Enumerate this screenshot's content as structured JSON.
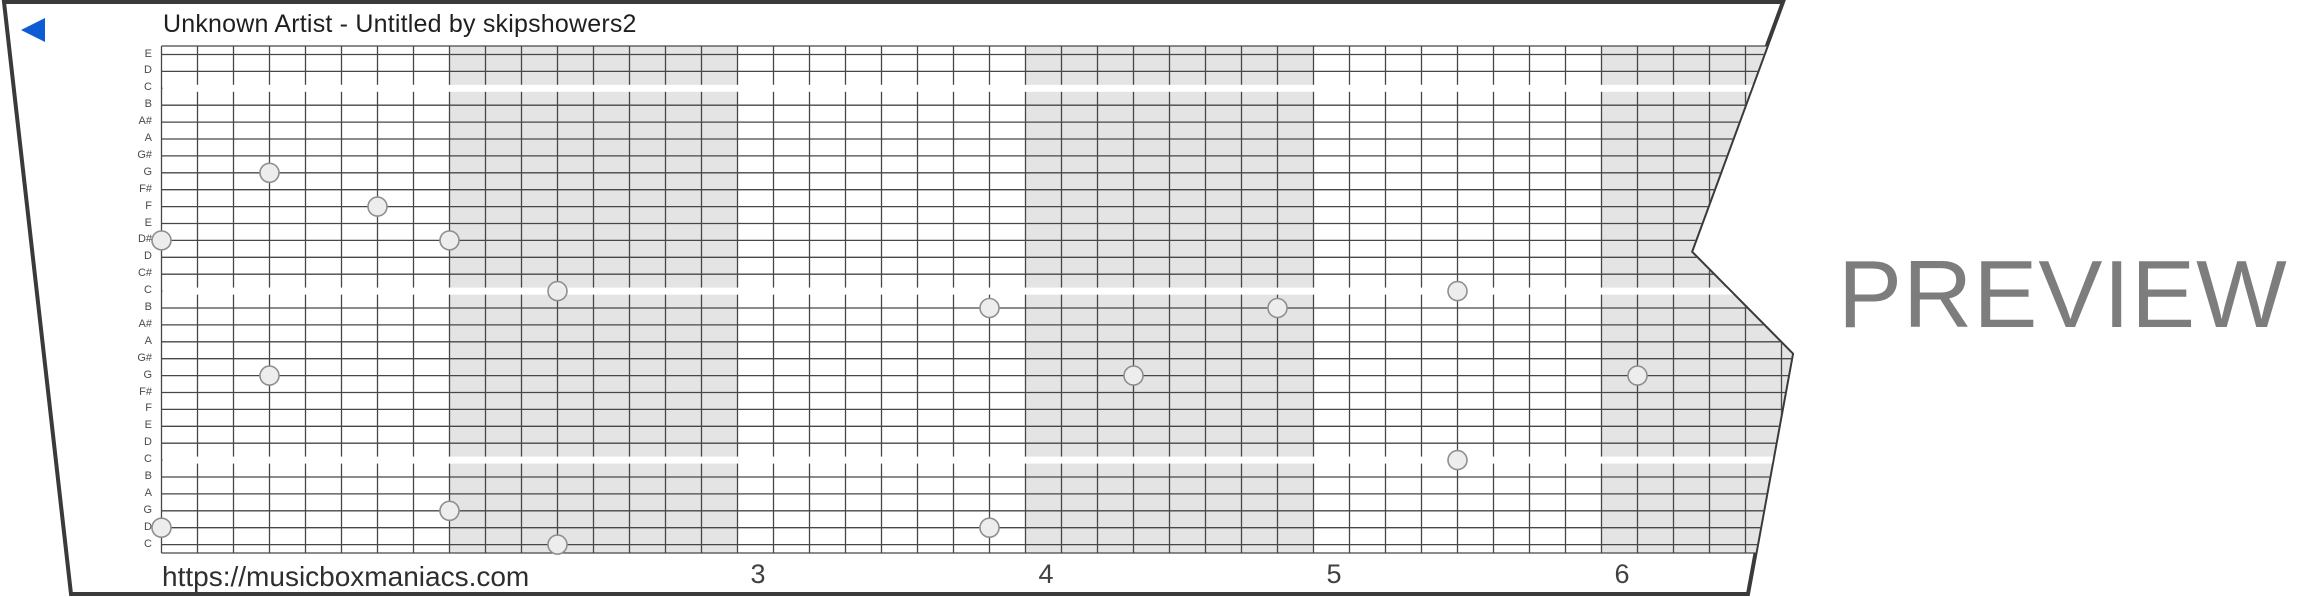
{
  "header": {
    "title": "Unknown Artist - Untitled by skipshowers2"
  },
  "player": {
    "play_button_color": "#0d5bd5"
  },
  "watermark": {
    "text": "PREVIEW",
    "color": "#7d7d7d"
  },
  "footer": {
    "url": "https://musicboxmaniacs.com",
    "beat_numbers": [
      {
        "label": "3",
        "beat": 3
      },
      {
        "label": "4",
        "beat": 4
      },
      {
        "label": "5",
        "beat": 5
      },
      {
        "label": "6",
        "beat": 6
      }
    ]
  },
  "strip": {
    "note_labels_top_to_bottom": [
      "E",
      "D",
      "C",
      "B",
      "A#",
      "A",
      "G#",
      "G",
      "F#",
      "F",
      "E",
      "D#",
      "D",
      "C#",
      "C",
      "B",
      "A#",
      "A",
      "G#",
      "G",
      "F#",
      "F",
      "E",
      "D",
      "C",
      "B",
      "A",
      "G",
      "D",
      "C"
    ],
    "octave_white_line_rows": [
      3,
      15,
      25
    ],
    "shaded_beats": [
      2,
      4,
      6
    ],
    "colors": {
      "paper": "#ffffff",
      "border": "#3a3a3a",
      "grid_line": "#474747",
      "shaded_band": "#e4e4e4",
      "octave_line": "#ffffff",
      "hole_fill": "#ededed",
      "hole_stroke": "#8f8f8f",
      "label_text": "#4a4a4a"
    },
    "holes": [
      {
        "col": 0,
        "row": 12,
        "note": "D#"
      },
      {
        "col": 0,
        "row": 29,
        "note": "D"
      },
      {
        "col": 3,
        "row": 8,
        "note": "G"
      },
      {
        "col": 3,
        "row": 20,
        "note": "G"
      },
      {
        "col": 6,
        "row": 10,
        "note": "F"
      },
      {
        "col": 8,
        "row": 12,
        "note": "D#"
      },
      {
        "col": 8,
        "row": 28,
        "note": "G"
      },
      {
        "col": 11,
        "row": 15,
        "note": "C"
      },
      {
        "col": 11,
        "row": 30,
        "note": "C"
      },
      {
        "col": 23,
        "row": 16,
        "note": "B"
      },
      {
        "col": 23,
        "row": 29,
        "note": "D"
      },
      {
        "col": 27,
        "row": 20,
        "note": "G"
      },
      {
        "col": 31,
        "row": 16,
        "note": "B"
      },
      {
        "col": 36,
        "row": 15,
        "note": "C"
      },
      {
        "col": 36,
        "row": 25,
        "note": "C"
      },
      {
        "col": 41,
        "row": 20,
        "note": "G"
      }
    ]
  }
}
